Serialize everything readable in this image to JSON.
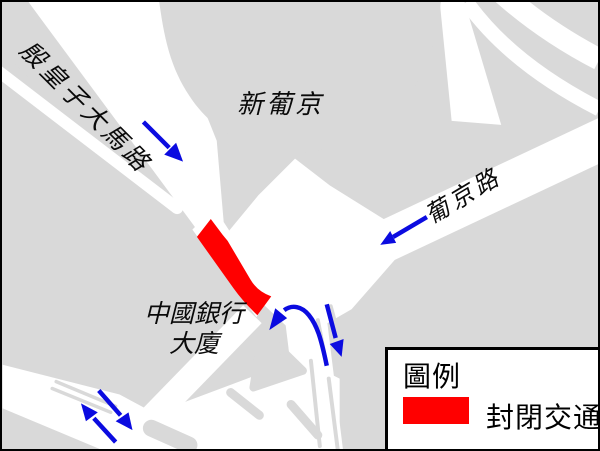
{
  "map": {
    "labels": {
      "road_nw": "殷皇子大馬路",
      "building_top": "新葡京",
      "road_ne": "葡京路",
      "building_left_line1": "中國銀行",
      "building_left_line2": "大廈"
    },
    "legend": {
      "title": "圖例",
      "items": [
        {
          "swatch_color": "#ff0000",
          "label": "封閉交通"
        }
      ]
    },
    "arrows": {
      "count": 6,
      "color": "#0b0be0",
      "directions": [
        "southeast-along-avenida-infante",
        "southwest-along-avenida-de-lisboa",
        "left-turn-curve-at-junction",
        "south-at-junction",
        "northwest-bottom-road",
        "southeast-bottom-road"
      ]
    },
    "colors": {
      "block_gray": "#d9d9d9",
      "road_white": "#ffffff",
      "closed_red": "#ff0000",
      "arrow_blue": "#0b0be0",
      "outline_black": "#000000"
    }
  }
}
